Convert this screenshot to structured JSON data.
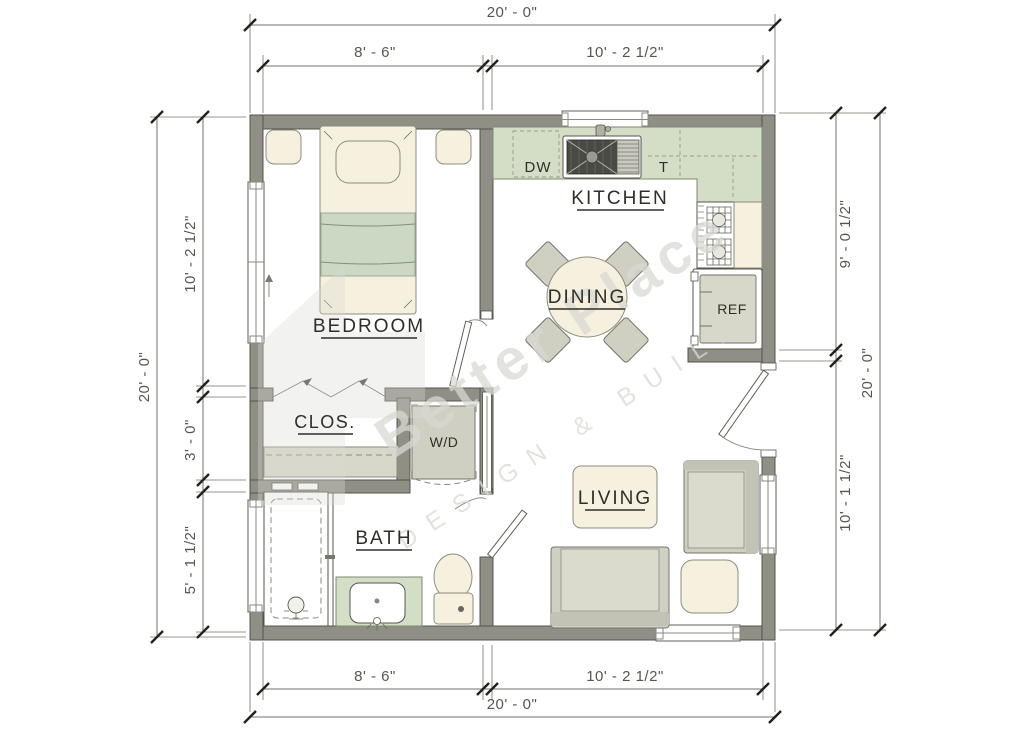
{
  "rooms": {
    "bedroom": "BEDROOM",
    "kitchen": "KITCHEN",
    "dining": "DINING",
    "closet": "CLOS.",
    "bath": "BATH",
    "living": "LIVING"
  },
  "labels": {
    "dishwasher": "DW",
    "tall_cabinet": "T",
    "fridge": "REF",
    "washer_dryer": "W/D"
  },
  "dimensions": {
    "top": {
      "overall": "20' - 0\"",
      "segment_left": "8' - 6\"",
      "segment_right": "10' - 2 1/2\""
    },
    "bottom": {
      "overall": "20' - 0\"",
      "segment_left": "8' - 6\"",
      "segment_right": "10' - 2 1/2\""
    },
    "left": {
      "overall": "20' - 0\"",
      "segment_top": "10' - 2 1/2\"",
      "segment_middle": "3' - 0\"",
      "segment_bottom": "5' - 1 1/2\""
    },
    "right": {
      "overall": "20' - 0\"",
      "segment_top": "9' - 0 1/2\"",
      "segment_bottom": "10' - 1 1/2\""
    }
  },
  "watermark": {
    "name": "Better Place",
    "tagline": "DESIGN & BUILD"
  },
  "colors": {
    "wall": "#8f8f86",
    "wallstroke": "#53534c",
    "counter": "#d4ddc5",
    "cream": "#f6f1de",
    "furn": "#cfcfc2",
    "furnlight": "#dadacd",
    "furndark": "#c2c2b5",
    "blanket": "#cbd8c4",
    "label": "#2e2e29",
    "dim": "#56564f",
    "dimline": "#70706a",
    "wm": "#d9d9d3"
  }
}
